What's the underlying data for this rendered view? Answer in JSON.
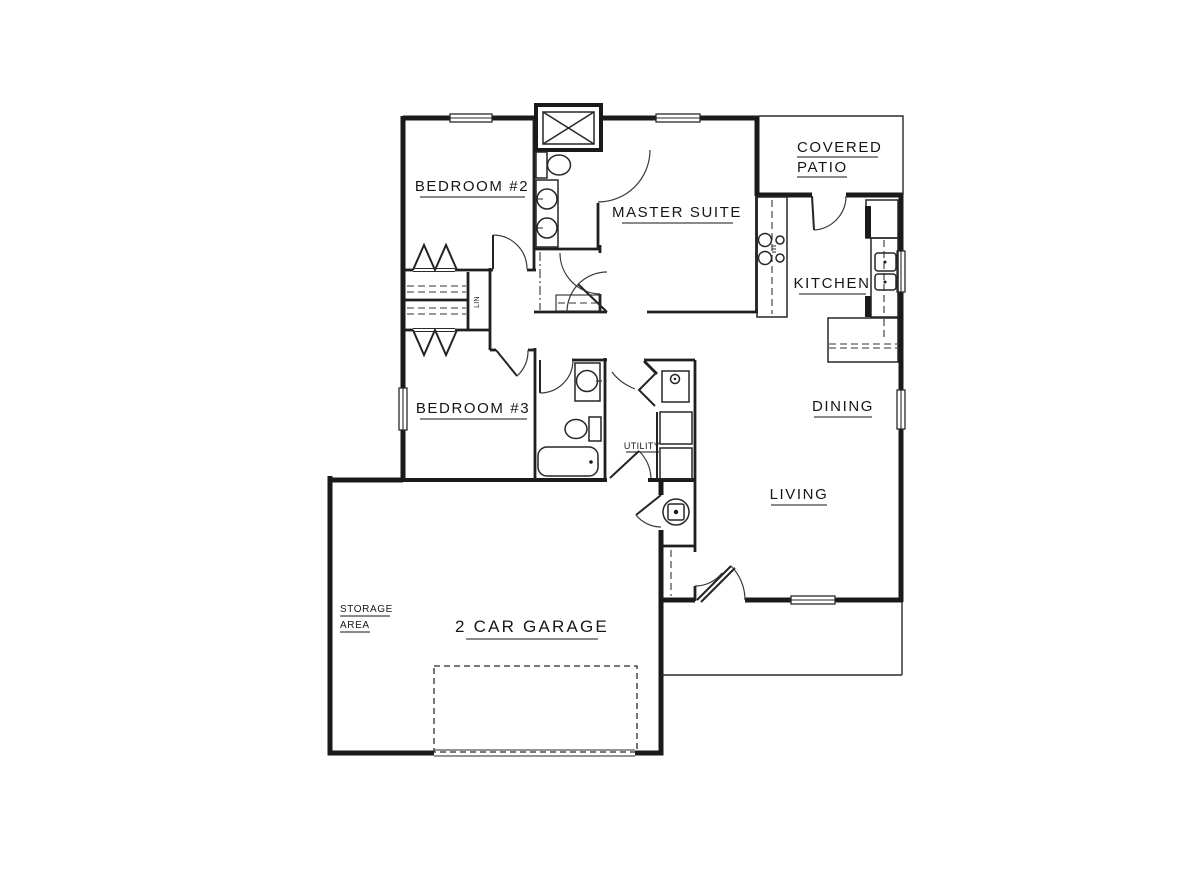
{
  "drawing_type": "residential-floor-plan",
  "colors": {
    "background": "#ffffff",
    "line": "#1a1a1a",
    "text": "#161616"
  },
  "labels": {
    "bedroom2": "BEDROOM #2",
    "master_suite": "MASTER SUITE",
    "covered_patio_line1": "COVERED",
    "covered_patio_line2": "PATIO",
    "kitchen": "KITCHEN",
    "dining": "DINING",
    "living": "LIVING",
    "bedroom3": "BEDROOM #3",
    "utility": "UTILITY",
    "linen_closet": "LIN",
    "storage_line1": "STORAGE",
    "storage_line2": "AREA",
    "garage": "2 CAR GARAGE"
  },
  "fixtures": [
    "shower",
    "master-toilet",
    "double-vanity-sinks",
    "walk-in-closet-rod",
    "hall-bath-pedestal-sink",
    "hall-bath-toilet",
    "bathtub",
    "range-cooktop",
    "refrigerator",
    "kitchen-double-sink",
    "eating-bar-counter",
    "laundry-sink",
    "washer",
    "dryer",
    "water-heater",
    "linen-shelves",
    "closet-bifold-doors",
    "coat-closet-rod",
    "garage-overhead-door"
  ]
}
